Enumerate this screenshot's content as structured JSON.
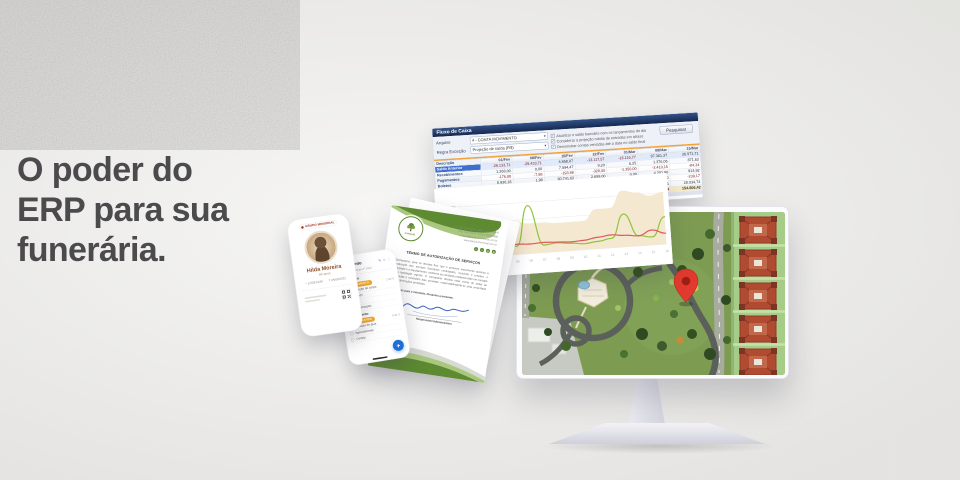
{
  "hero": {
    "headline": "O poder do\nERP para sua\nfunerária."
  },
  "cashflow": {
    "title": "Fluxo de Caixa",
    "search_button": "Pesquisar",
    "fields": [
      {
        "label": "Arquivo",
        "value": "4 - CONTA MOVIMENTO"
      },
      {
        "label": "Regra Exceção",
        "value": "Projeção de saída (R$)"
      }
    ],
    "options": [
      {
        "label": "Atualizar o saldo bancário com os lançamentos do dia",
        "checked": true
      },
      {
        "label": "Considerar a projeção média de entradas em atraso",
        "checked": true
      },
      {
        "label": "Demonstrar contas vencidas até a data no saldo final",
        "checked": true
      }
    ],
    "table": {
      "columns": [
        "Descrição",
        "01/Fev",
        "08/Fev",
        "15/Fev",
        "22/Fev",
        "01/Mar",
        "08/Mar",
        "15/Mar"
      ],
      "rows": [
        {
          "label": "Saldo Anterior",
          "selected": true,
          "values": [
            "-29.133,71",
            "-29.433,71",
            "4.958,07",
            "-13.117,57",
            "-16.116,77",
            "87.361,37",
            "26.571,71"
          ]
        },
        {
          "label": "Recebimentos",
          "values": [
            "1.268,00",
            "0,00",
            "7.594,47",
            "9,20",
            "6,25",
            "1.376,06",
            "871,62"
          ]
        },
        {
          "label": "Pagamentos",
          "values": [
            "-176,88",
            "-7,98",
            "-193,98",
            "-320,00",
            "-1.350,00",
            "-2.410,15",
            "-84,34"
          ]
        },
        {
          "label": "Boletos",
          "values": [
            "8.930,18",
            "1,98",
            "60.741,62",
            "2.699,00",
            "0,00",
            "4.201,90",
            "914,92"
          ]
        },
        {
          "label": "Cheques",
          "values": [
            "-35.712,19",
            "-1,48",
            "-11.461,20",
            "0,00",
            "0,00",
            "-1.428,00",
            "-239,17"
          ]
        },
        {
          "label": "Saldo do Dia",
          "values": [
            "24.415,40",
            "-29.441,17",
            "31.638,91",
            "-10.729,37",
            "-17.460,52",
            "89.099,21",
            "28.034,74"
          ]
        }
      ],
      "totals": {
        "label": "Saldo Final",
        "values": [
          "-29.133,71",
          "-58.574,88",
          "-26.935,97",
          "-37.665,34",
          "-54.783,86",
          "-71.363,84",
          "154.606,42"
        ]
      }
    }
  },
  "chart_data": {
    "type": "line",
    "title": "",
    "categories": [
      "01",
      "02",
      "03",
      "04",
      "05",
      "06",
      "07",
      "08",
      "09",
      "10",
      "11",
      "12",
      "13",
      "14",
      "15",
      "16"
    ],
    "ylabels": [
      "R$ 75,00",
      "R$ 50,00",
      "R$ 25,00",
      "R$ 0,00"
    ],
    "ytick_values": [
      75,
      50,
      25,
      0
    ],
    "ylim": [
      0,
      90
    ],
    "grid": true,
    "legend_position": "none",
    "series": [
      {
        "name": "Projeção de saldo",
        "type": "area",
        "color": "#f4e8d0",
        "values": [
          26,
          26,
          26,
          48,
          48,
          44,
          44,
          42,
          42,
          42,
          58,
          58,
          82,
          78,
          72,
          76
        ]
      },
      {
        "name": "Entradas",
        "type": "line",
        "color": "#8cc63f",
        "values": [
          9,
          6,
          10,
          44,
          12,
          70,
          11,
          13,
          11,
          9,
          11,
          14,
          48,
          15,
          12,
          40
        ]
      },
      {
        "name": "Saídas",
        "type": "line",
        "color": "#e05c5c",
        "values": [
          12,
          9,
          13,
          17,
          15,
          14,
          15,
          14,
          13,
          14,
          17,
          19,
          17,
          15,
          22,
          16
        ]
      }
    ]
  },
  "memorial_phone": {
    "brand": "GRUPO MEMORIAL",
    "name": "Hilda Moreira",
    "age": "84 anos",
    "dates": [
      {
        "symbol": "*",
        "text": "12/03/1938"
      },
      {
        "symbol": "†",
        "text": "05/08/2022"
      }
    ]
  },
  "tasks_phone": {
    "title": "Meu Evento",
    "subtitle": "Ordem de serviço nº 1042",
    "header_icons": [
      {
        "glyph": "✎",
        "name": "edit-icon"
      },
      {
        "glyph": "☆",
        "name": "star-icon"
      },
      {
        "glyph": "⋮",
        "name": "overflow-icon"
      }
    ],
    "fab_label": "+",
    "groups": [
      {
        "title": "Preparação",
        "chip": "EM ANDAMENTO",
        "note": "2 de 4",
        "items": [
          {
            "label": "Preparação do corpo",
            "done": true
          },
          {
            "label": "Translado",
            "done": true
          },
          {
            "label": "Velório",
            "done": false
          },
          {
            "label": "Documentação",
            "done": false
          }
        ]
      },
      {
        "title": "Sepultamento",
        "chip": "AGUARDANDO",
        "note": "0 de 3",
        "items": [
          {
            "label": "Emissão de guia",
            "done": false
          },
          {
            "label": "Agendamento",
            "done": false
          },
          {
            "label": "Cortejo",
            "done": false
          }
        ]
      }
    ]
  },
  "document": {
    "logo_label": "PARQUE",
    "contact_lines": [
      "Av. das Araucárias, 1200 - Curitiba/PR",
      "(41) 3333-4444  •  (41) 9 9999-8888",
      "contato@parquememorial.com.br",
      "www.parquememorial.com.br"
    ],
    "social_icons": [
      "f",
      "t",
      "@",
      "in"
    ],
    "title": "TERMO DE AUTORIZAÇÃO DE SERVIÇOS",
    "paragraph": "Declaramos, para os devidos fins, que o presente instrumento autoriza a realização dos serviços funerários contratados, incluindo o preparo, o translado e o sepultamento, conforme as condições estabelecidas em contrato e a legislação vigente. O contratante declara estar ciente de todas as cláusulas e condições aqui previstas, responsabilizando-se pela veracidade das informações prestadas.",
    "closing": "Sem mais para o momento, firmamos a presente.",
    "signer": "Responsável Administrativo"
  },
  "map": {
    "pin_color": "#e23a2e",
    "lawn_color": "#7d9c52",
    "road_color": "#5c605b",
    "strip_color": "#a6cd88",
    "building_color": "#b04a31"
  }
}
